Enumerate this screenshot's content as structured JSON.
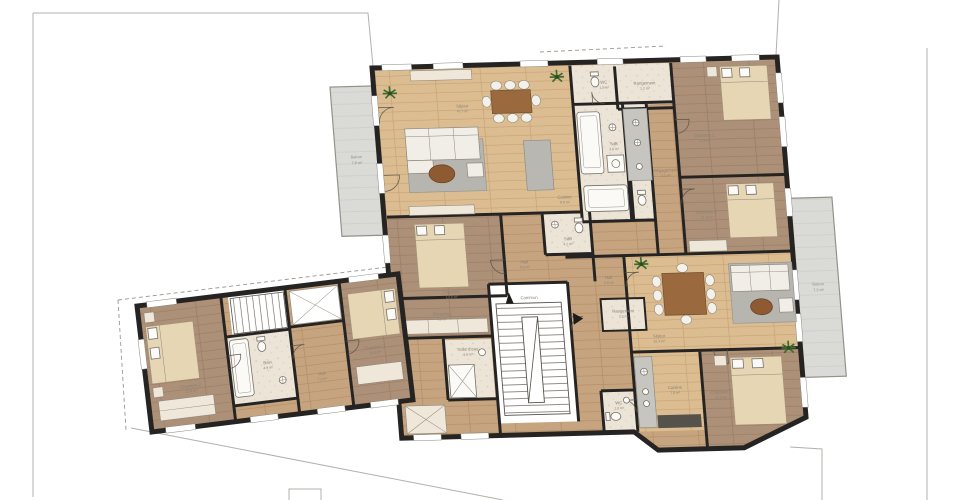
{
  "plan_type": "architectural-floor-plan",
  "palette": {
    "wall": "#262422",
    "wood_light": "#dcbd92",
    "wood_mid": "#c6a47f",
    "wood_dark": "#ac9078",
    "tile": "#ece4d6",
    "balcony": "#dadad6",
    "rug": "#b7b5b0",
    "table_wood": "#9a6a3e",
    "bed_blanket": "#e7d6b4",
    "plant": "#3f6b2e",
    "label_text": "#8a8175"
  },
  "labels": {
    "sejour_a": {
      "name": "Séjour",
      "area": "47.7 m²"
    },
    "cuisine_a": {
      "name": "Cuisine",
      "area": "9.8 m²"
    },
    "wc_a": {
      "name": "WC",
      "area": "1.5 m²"
    },
    "rangement_a": {
      "name": "Rangement",
      "area": "1.2 m²"
    },
    "sdb_a": {
      "name": "SdB",
      "area": "3.8 m²"
    },
    "degagement_a": {
      "name": "Dégagement",
      "area": "4.1 m²"
    },
    "chambre1_a": {
      "name": "Chambre 1",
      "area": "12.8 m²"
    },
    "chambre2_a": {
      "name": "Chambre 2",
      "area": "11.9 m²"
    },
    "chambre_b": {
      "name": "Chambre",
      "area": "13.5 m²"
    },
    "dressing_b": {
      "name": "Dressing",
      "area": "4.6 m²"
    },
    "hall_b": {
      "name": "Hall",
      "area": "6.8 m²"
    },
    "sdb_b": {
      "name": "SdB",
      "area": "4.2 m²"
    },
    "commun": {
      "name": "Commun",
      "area": ""
    },
    "salle_eau": {
      "name": "Salle d'eau",
      "area": "4.8 m²"
    },
    "sejour_c": {
      "name": "Séjour",
      "area": "32.4 m²"
    },
    "cuisine_c": {
      "name": "Cuisine",
      "area": "7.8 m²"
    },
    "rangement_c": {
      "name": "Rangement",
      "area": "3.2 m²"
    },
    "wc_c": {
      "name": "WC",
      "area": "1.8 m²"
    },
    "hall_c": {
      "name": "Hall",
      "area": "5.6 m²"
    },
    "chambre1_c": {
      "name": "Chambre 1",
      "area": "12.2 m²"
    },
    "balcon_left": {
      "name": "Balcon",
      "area": "7.8 m²"
    },
    "balcon_right": {
      "name": "Balcon",
      "area": "7.3 m²"
    },
    "w_chambre1": {
      "name": "Chambre 1",
      "area": "14.6 m²"
    },
    "w_chambre2": {
      "name": "Chambre 2",
      "area": "12.9 m²"
    },
    "w_bain": {
      "name": "Bain",
      "area": "4.9 m²"
    },
    "w_hall": {
      "name": "Hall",
      "area": "7.2 m²"
    }
  }
}
